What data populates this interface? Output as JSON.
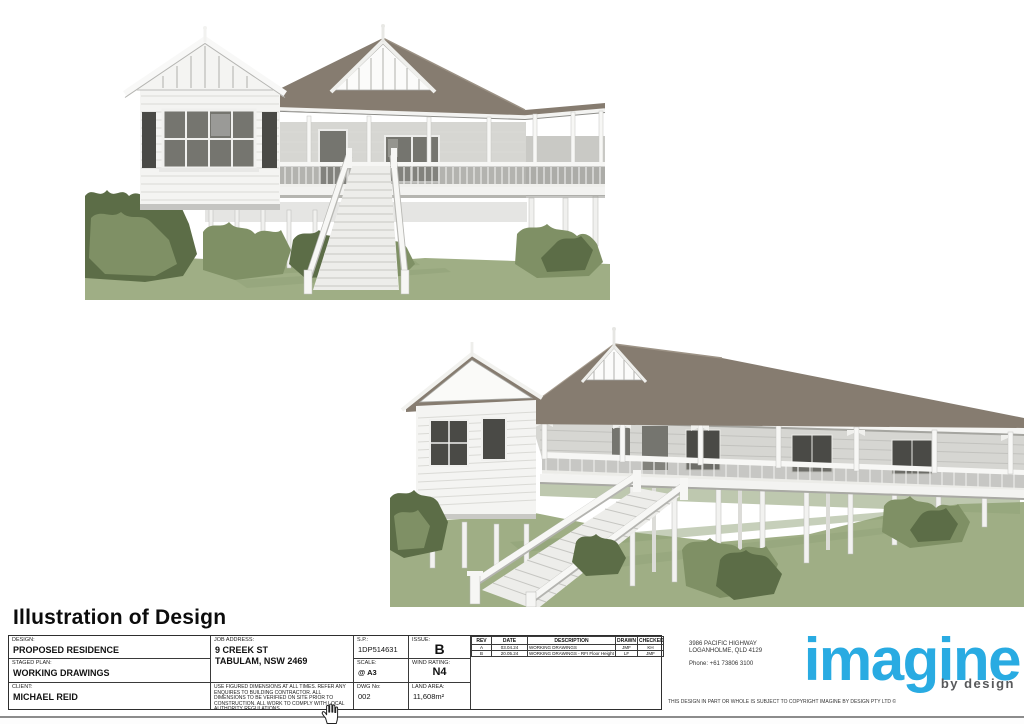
{
  "page": {
    "heading": "Illustration of Design"
  },
  "titleblock": {
    "design_label": "DESIGN:",
    "design_value": "PROPOSED RESIDENCE",
    "staged_plan_label": "STAGED PLAN:",
    "staged_plan_value": "WORKING DRAWINGS",
    "client_label": "CLIENT:",
    "client_value": "MICHAEL REID",
    "job_address_label": "JOB ADDRESS:",
    "job_address_line1": "9 CREEK ST",
    "job_address_line2": "TABULAM, NSW 2469",
    "disclaimer": "USE FIGURED DIMENSIONS AT ALL TIMES. REFER ANY ENQUIRES TO BUILDING CONTRACTOR. ALL DIMENSIONS TO BE VERIFIED ON SITE PRIOR TO CONSTRUCTION. ALL WORK TO COMPLY WITH LOCAL AUTHORITY REGULATIONS.",
    "sp_label": "S.P.:",
    "sp_value": "1DP514631",
    "issue_label": "ISSUE:",
    "issue_value": "B",
    "scale_label": "SCALE:",
    "scale_value": "@ A3",
    "wind_label": "WIND RATING:",
    "wind_value": "N4",
    "dwg_label": "DWG No:",
    "dwg_value": "002",
    "land_label": "LAND AREA:",
    "land_value": "11,608m²",
    "rev_headers": [
      "REV",
      "DATE",
      "DESCRIPTION",
      "DRAWN",
      "CHECKED"
    ],
    "revisions": [
      {
        "rev": "A",
        "date": "03.04.24",
        "description": "WORKING DRAWINGS",
        "drawn": "JMF",
        "checked": "KH"
      },
      {
        "rev": "B",
        "date": "20.05.24",
        "description": "WORKING DRAWINGS - RFI Floor Height",
        "drawn": "LF",
        "checked": "JMF"
      }
    ]
  },
  "company": {
    "address_line1": "3986 PACIFIC HIGHWAY",
    "address_line2": "LOGANHOLME, QLD 4129",
    "phone": "Phone:  +61 73806 3100",
    "logo_text": "imagine",
    "logo_sub": "by design",
    "copyright": "THIS DESIGN IN PART OR WHOLE IS SUBJECT TO COPYRIGHT IMAGINE BY DESIGN PTY LTD ©"
  },
  "colors": {
    "accent_logo": "#29abe2",
    "logo_sub": "#58595b",
    "roof": "#867c70",
    "wall": "#f4f4f2",
    "wall_shade": "#d6d6d2",
    "glass": "#75756f",
    "glass_dark": "#4a4a46",
    "foliage_light": "#a3b188",
    "foliage_mid": "#7f9065",
    "foliage_dark": "#5c6d47",
    "ground": "#9fae85",
    "stair": "#ededea"
  }
}
